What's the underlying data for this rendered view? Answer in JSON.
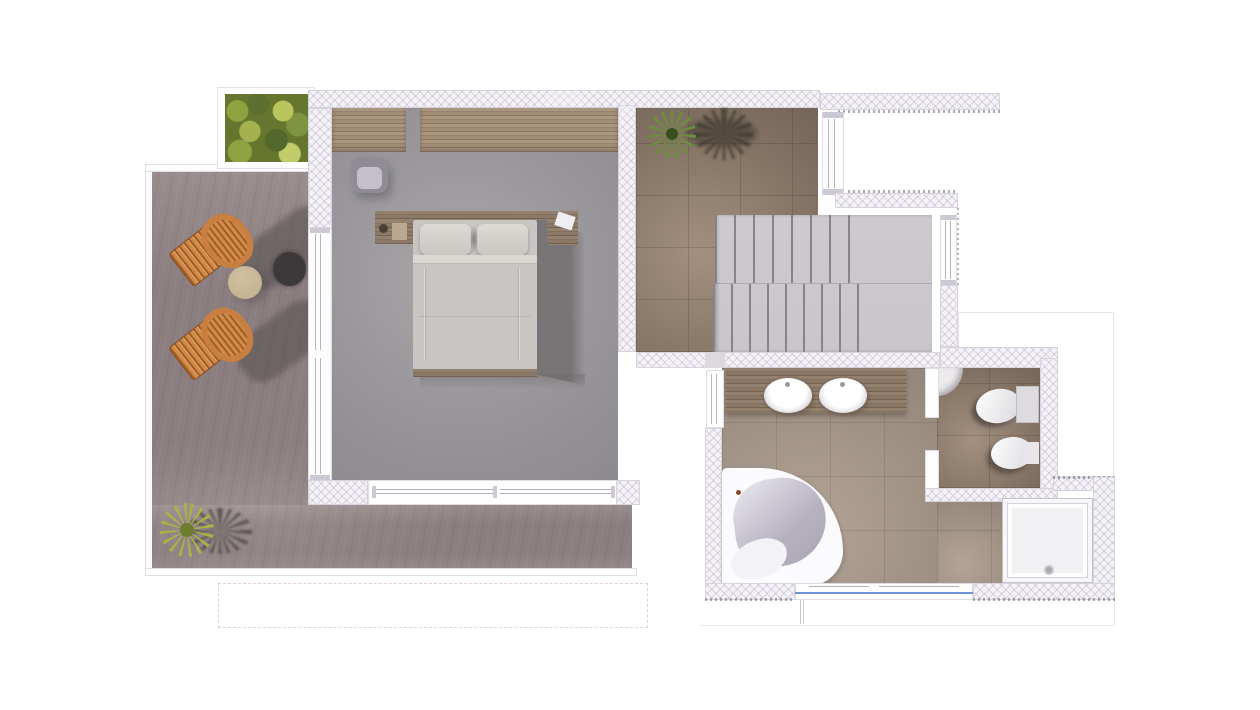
{
  "scene": {
    "type": "floor-plan-render",
    "view": "top-down",
    "description": "3D rendered upper-floor plan: terrace with sun loungers, bedroom with double bed, stair hall with staircase, bathroom with double vanity and corner bathtub, separate WC, shower"
  },
  "rooms": [
    {
      "id": "terrace",
      "label": "terrace"
    },
    {
      "id": "bedroom",
      "label": "bedroom"
    },
    {
      "id": "stair-hall",
      "label": "stair hall"
    },
    {
      "id": "bathroom",
      "label": "bathroom"
    },
    {
      "id": "wc",
      "label": "wc"
    },
    {
      "id": "shower",
      "label": "shower"
    }
  ],
  "furniture": [
    "planter-box",
    "sun-lounger",
    "sun-lounger",
    "side-table-beige",
    "side-table-dark",
    "terrace-plant",
    "wardrobe",
    "armchair",
    "double-bed",
    "nightstand",
    "nightstand",
    "staircase",
    "hall-plant",
    "vanity-double-sink",
    "corner-bathtub",
    "shower-tray",
    "corner-washbasin",
    "toilet",
    "bidet"
  ],
  "colors": {
    "wall-bg": "#f4f2f6",
    "wall-edge": "#d6d2de",
    "deck1": "#9a8d8e",
    "deck2": "#8b7e80",
    "bedfloor1": "#a8a6a9",
    "bedfloor2": "#929094",
    "tilebrown1": "#a3907f",
    "tilebrown2": "#837263",
    "tilebeige1": "#b3a495",
    "tilebeige2": "#9c8e80",
    "stair": "#c9c6cb",
    "stairslat": "#87828c",
    "wood1": "#ab9680",
    "wood2": "#8d7862",
    "wooddark1": "#94806e",
    "wooddark2": "#76634f",
    "orange1": "#cf8a4a",
    "orange2": "#a25d24",
    "porcelain": "#f4f3f6",
    "glass": "#6b93d6",
    "shadow": "#55504e",
    "bedshadow": "#6f6b6d",
    "mattress": "#c8c5c3",
    "pillow": "#dad6d1",
    "green": "#6a8f3a",
    "greendark": "#394f1f",
    "olive": "#a9b246",
    "tbeige": "#c9b794",
    "tdark": "#3d393a"
  }
}
